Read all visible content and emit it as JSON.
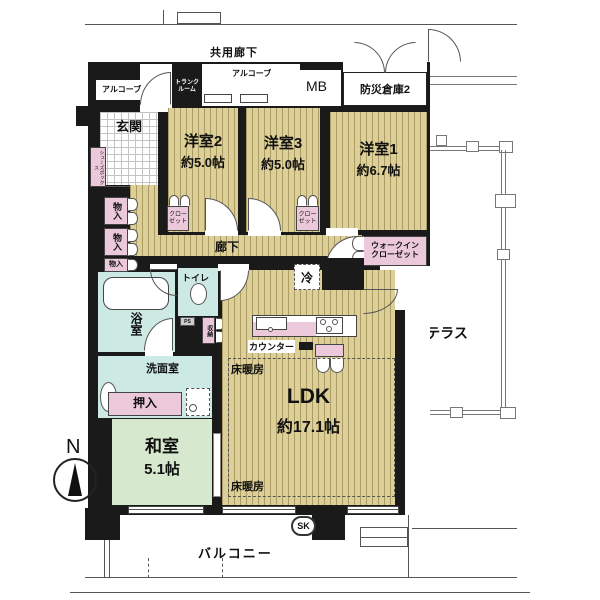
{
  "plan": {
    "exterior": {
      "common_corridor": "共用廊下",
      "alcove_left": "アルコーブ",
      "alcove_center": "アルコーブ",
      "trunk_room_line1": "トランク",
      "trunk_room_line2": "ルーム",
      "meter_box": "MB",
      "disaster_storage": "防災倉庫2",
      "roof_terrace": "ルーフテラス",
      "balcony": "バルコニー",
      "slop_sink": "SK",
      "north": "N"
    },
    "rooms": {
      "entrance": "玄関",
      "bedroom2_name": "洋室2",
      "bedroom2_size": "約5.0帖",
      "bedroom3_name": "洋室3",
      "bedroom3_size": "約5.0帖",
      "bedroom1_name": "洋室1",
      "bedroom1_size": "約6.7帖",
      "corridor": "廊下",
      "ldk_name": "LDK",
      "ldk_size": "約17.1帖",
      "japanese_room_name": "和室",
      "japanese_room_size": "5.1帖",
      "bath": "浴室",
      "washroom": "洗面室",
      "toilet": "トイレ"
    },
    "storage": {
      "shoe_box": "シューズボックス",
      "storage1": "物入",
      "storage2": "物入",
      "storage3": "物入",
      "closet2_l1": "クロー",
      "closet2_l2": "ゼット",
      "closet3_l1": "クロー",
      "closet3_l2": "ゼット",
      "wic_l1": "ウォークイン",
      "wic_l2": "クローゼット",
      "hall_storage": "収納",
      "oshiire": "押入"
    },
    "fixtures": {
      "fridge": "冷",
      "counter": "カウンター",
      "floor_heating_top": "床暖房",
      "floor_heating_bottom": "床暖房",
      "pipe_space": "PS"
    },
    "colors": {
      "wall": "#1a1a1a",
      "wood": "#dccf97",
      "tatami": "#d6e9cf",
      "water": "#cde9e4",
      "pink": "#ecc9da",
      "outline": "#666666"
    }
  }
}
